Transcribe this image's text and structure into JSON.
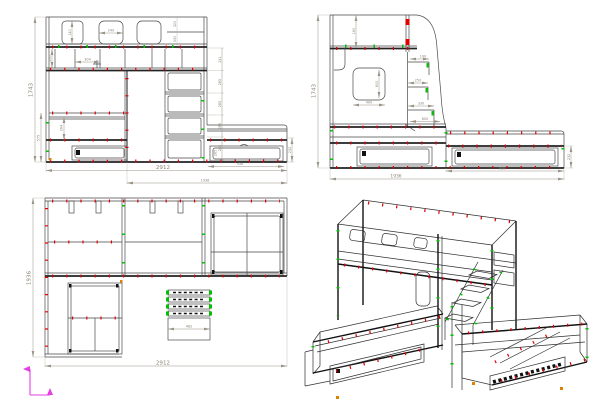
{
  "colors": {
    "line": "#4a4a4a",
    "dim_text": "#8b8574",
    "red_marker": "#e00000",
    "green_marker": "#00c000",
    "orange_marker": "#e08200",
    "magenta_axes": "#e33fe3"
  },
  "d": {
    "f_h": "1743",
    "f_w": "2912",
    "f_w2": "1936",
    "f_bed": "575",
    "f_mat": "264",
    "f_cut_h": "140",
    "f_cut_w": "240",
    "f_sh_h": "250",
    "f_sh_w": "304",
    "f_tr1": "320",
    "f_tr2": "330",
    "f_s1": "241",
    "f_s2": "285",
    "f_s3": "285",
    "f_s4": "285",
    "f_s5": "285",
    "f_dw": "938",
    "f_dh": "232",
    "f_di": "285",
    "s_h": "1743",
    "s_rail": "160",
    "s_cw": "400",
    "s_ch": "600",
    "s_st1": "190",
    "s_st2": "250",
    "s_st3": "330",
    "s_plat": "600",
    "s_dw": "938",
    "s_dh": "232",
    "s_d": "1936",
    "p_d": "1936",
    "p_w": "2912",
    "p_st": "482"
  }
}
